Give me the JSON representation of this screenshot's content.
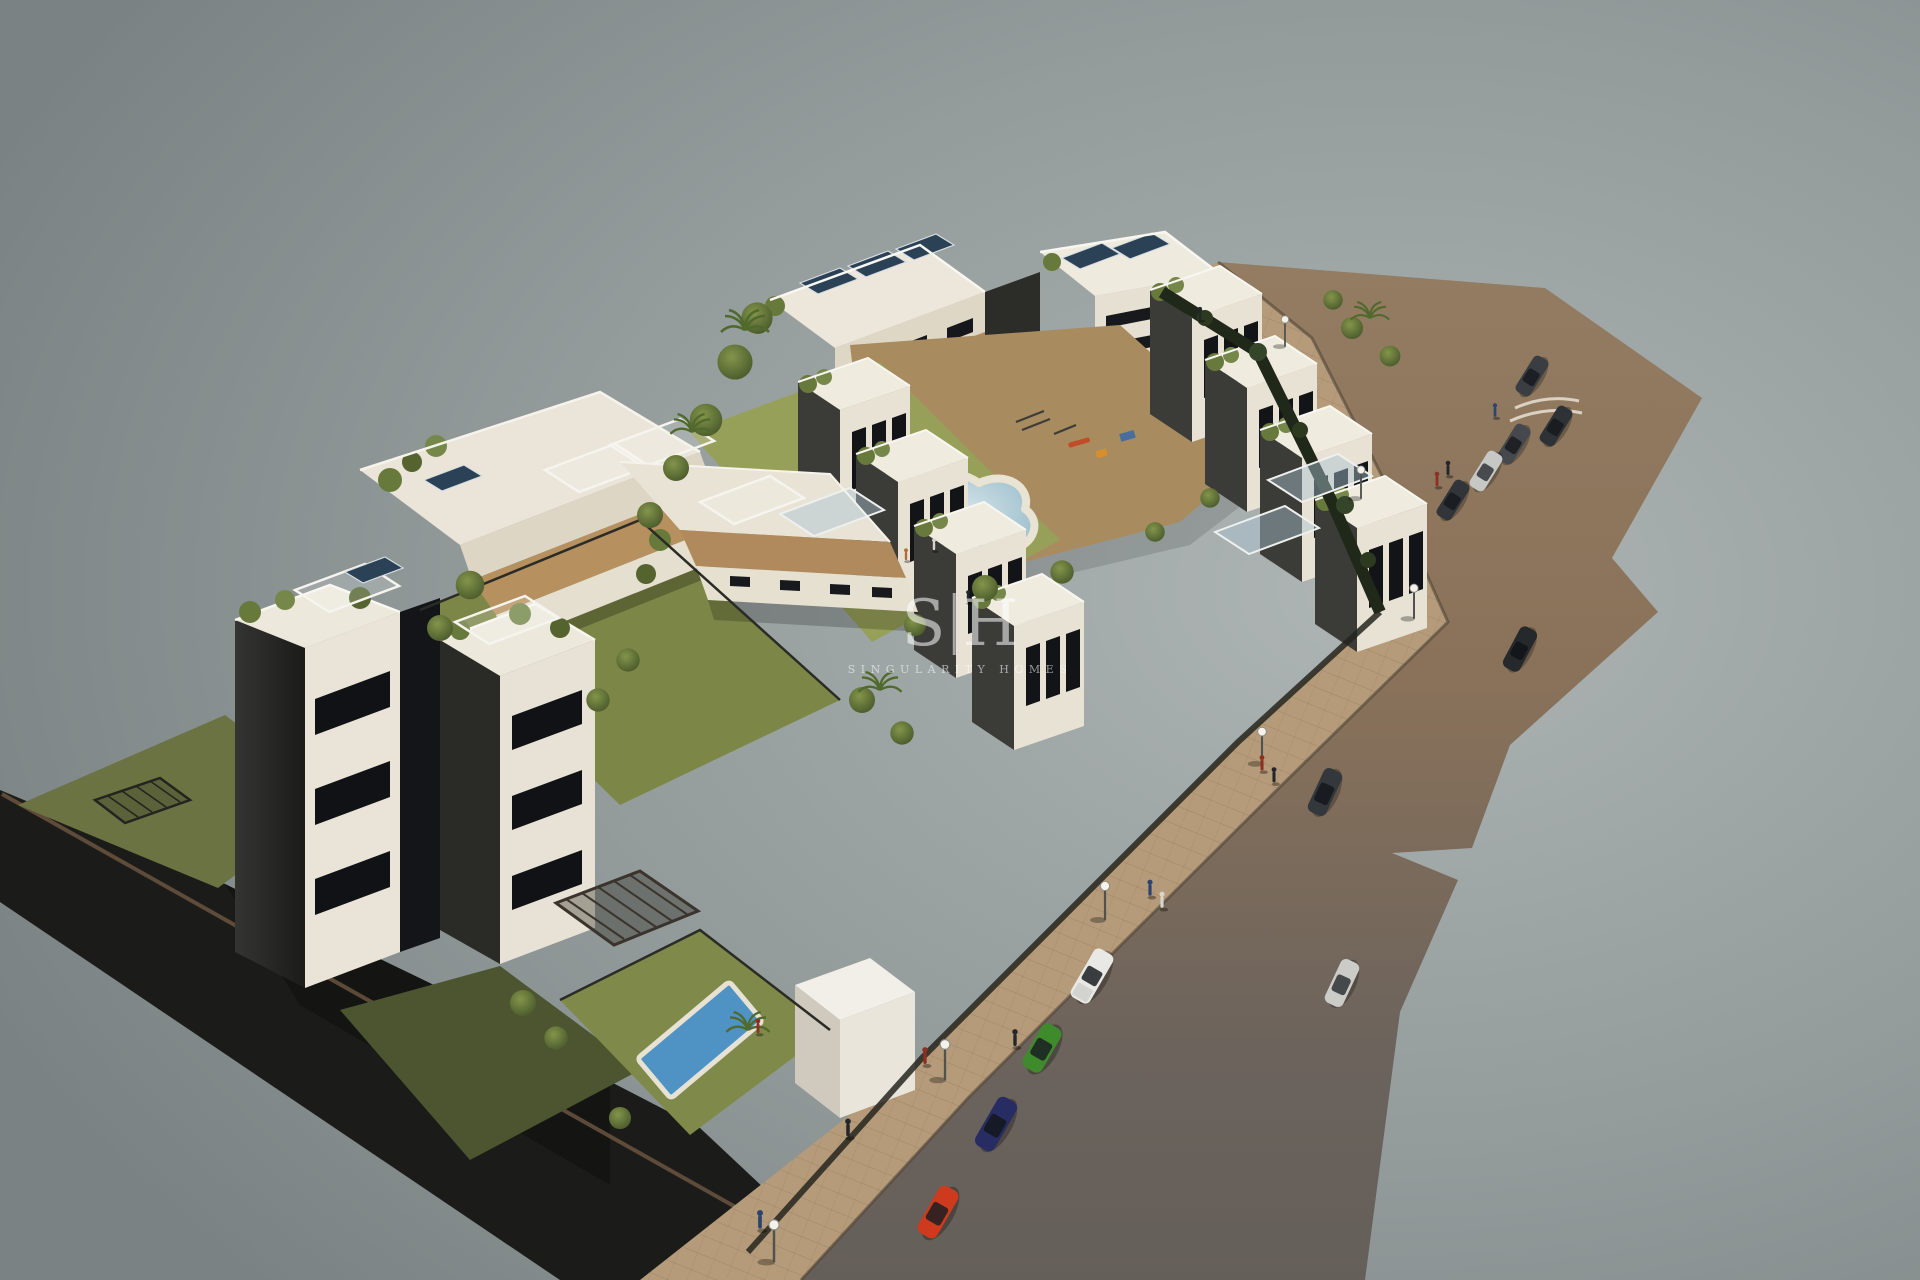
{
  "scene": {
    "type": "3d-architectural-render",
    "description": "Aerial isometric render of a white modern apartment development with rooftop terraces, solar panels, gardens, pools and a street wrapping the site",
    "background_center": "#aeb5b4",
    "background_edge": "#7a8283"
  },
  "watermark": {
    "logo_s": "S",
    "logo_h": "H",
    "name": "SINGULARITY HOMES",
    "color": "#ffffff"
  },
  "palette": {
    "road_top": "#937c61",
    "road_bottom": "#655f5a",
    "sidewalk": "#b59b79",
    "dark_wall": "#1b1b19",
    "building_lit": "#e9e4d7",
    "building_shade": "#2f2f2c",
    "window": "#121417",
    "deck_wood": "#b28b5e",
    "lawn": "#97a059",
    "lawn_shade": "#5d6839",
    "tree": "#5d7034",
    "pool_water": "#9fc2cf",
    "private_pool": "#4f93c4",
    "solar_panel": "#2b4156"
  },
  "cars": {
    "parked_top_row": [
      {
        "name": "dark-grey-car",
        "color": "#3a3e42"
      },
      {
        "name": "black-car",
        "color": "#2e3236"
      },
      {
        "name": "grey-car",
        "color": "#45494d"
      },
      {
        "name": "silver-car",
        "color": "#c7c8c5"
      },
      {
        "name": "dark-car",
        "color": "#31353a"
      }
    ],
    "moving": [
      {
        "name": "black-car",
        "color": "#26292c"
      },
      {
        "name": "dark-grey-suv",
        "color": "#33383c"
      },
      {
        "name": "silver-car",
        "color": "#cbcbc8"
      }
    ],
    "parked_bottom_row": [
      {
        "name": "white-pickup",
        "color": "#e8e8e4"
      },
      {
        "name": "green-hatchback",
        "color": "#3f8b2c"
      },
      {
        "name": "blue-sedan",
        "color": "#272c63"
      },
      {
        "name": "red-car",
        "color": "#cd3a1e"
      }
    ]
  }
}
